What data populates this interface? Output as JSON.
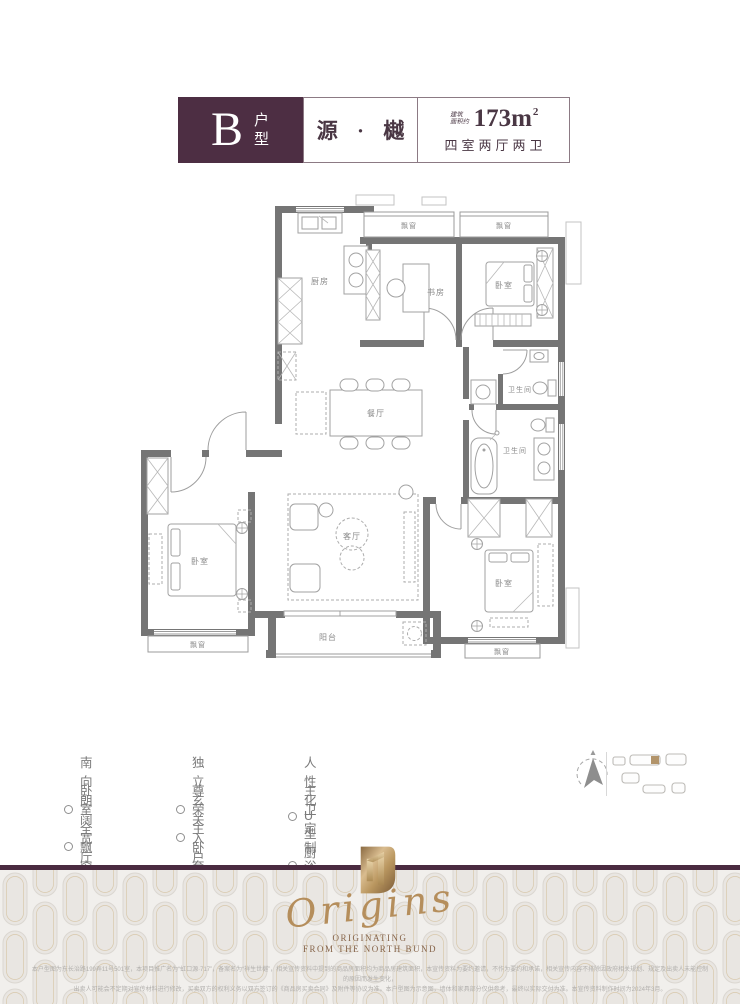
{
  "header": {
    "unit_letter": "B",
    "unit_type_label": "户型",
    "project_name": "源 · 樾",
    "area_prefix_line1": "建筑",
    "area_prefix_line2": "面积约",
    "area_value": "173m",
    "area_superscript": "2",
    "layout_summary": "四室两厅两卫"
  },
  "floorplan": {
    "labels": {
      "kitchen": "厨房",
      "study": "书房",
      "bedroom": "卧室",
      "dining_room": "餐厅",
      "living_room": "客厅",
      "bathroom": "卫生间",
      "balcony": "阳台",
      "bay_window": "飘窗"
    }
  },
  "features": [
    {
      "label": "南向朗阔宽厅"
    },
    {
      "label": "卧室全飘窗设计"
    },
    {
      "label": "独立玄关入户"
    },
    {
      "label": "尊荣主卧套房"
    },
    {
      "label": "人性化U型厨房"
    },
    {
      "label": "主卫定制浴缸双台盆"
    }
  ],
  "footer": {
    "brand_script": "Origins",
    "tagline_line1": "ORIGINATING",
    "tagline_line2": "FROM THE NORTH BUND",
    "disclaimer_line1": "本户型图为东长治路199弄11号501室，本项目推广名为“虹口源·717”，备案名为“祥生世樾”，相关宣传资料中提到的商品房面积均为商品房建筑面积，本宣传资料为要约邀请，不作为要约和承诺，相关宣传内容不排除因政府相关规划、规定及出卖人未能控制的原因而发生变化，",
    "disclaimer_line2": "出卖人可能会不定期对宣传材料进行修改，买卖双方的权利义务以双方签订的《商品房买卖合同》及附件等协议为准。本户型图为示意图，墙体和家具部分仅供参考，最终以实际交付为准。本宣传资料制作时间为2024年3月。"
  },
  "colors": {
    "plum": "#4d2e43",
    "gold": "#b58e5c",
    "wall_gray": "#757575"
  }
}
